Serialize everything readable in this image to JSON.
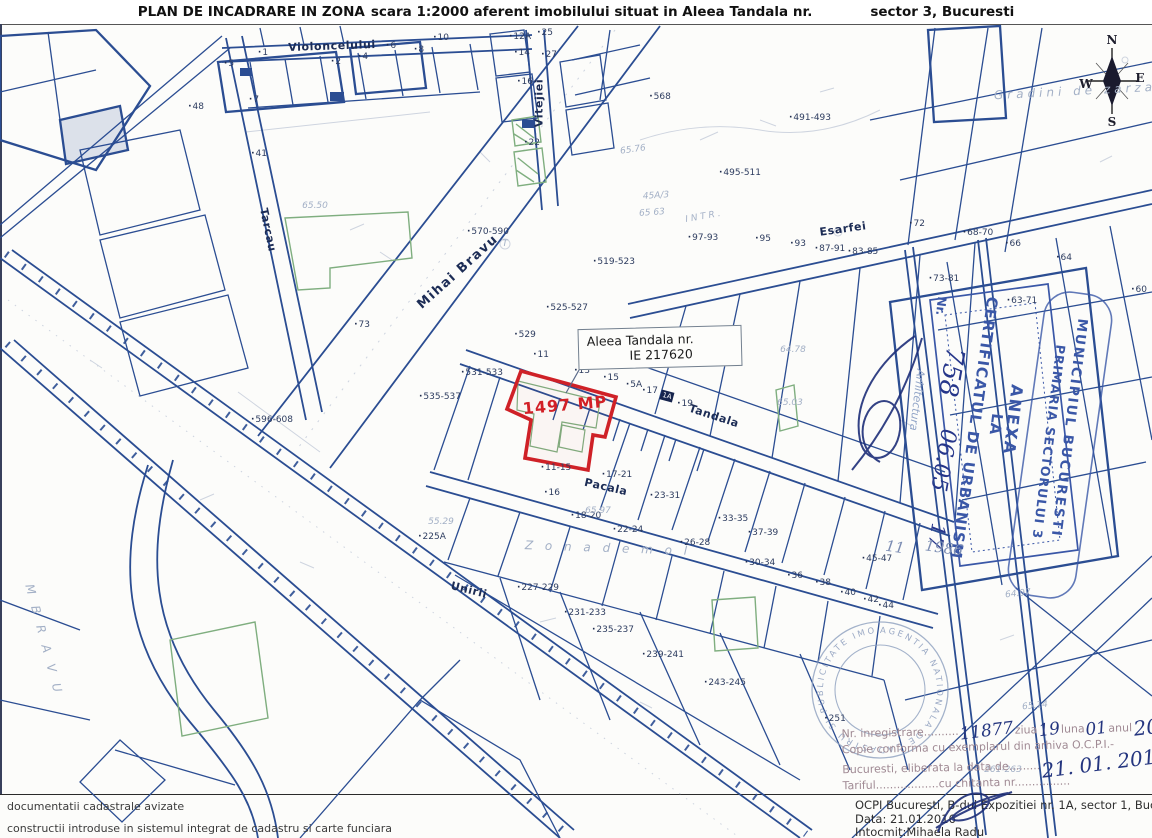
{
  "title": {
    "part1": "PLAN DE INCADRARE IN ZONA",
    "part2": "scara 1:2000 aferent imobilului situat in Aleea Tandala nr.",
    "part3": "sector 3, Bucuresti"
  },
  "parcel_box": {
    "line1": "Aleea Tandala nr.",
    "line2": "IE 217620"
  },
  "area_label": "1497 MP",
  "stamps": {
    "anexa": {
      "word1": "ANEXA",
      "word2": "LA",
      "cert": "CERTIFICATUL DE URBANISM",
      "nr_label": "Nr.",
      "hand_number": "758",
      "hand_date": "06.05",
      "hand_suffix": "17",
      "arch": "Arhitectura"
    },
    "primarie": {
      "line1": "MUNICIPIUL BUCURESTI",
      "line2": "PRIMARIA SECTORULUI 3",
      "hand_a": "11",
      "hand_b": "1986"
    },
    "round": {
      "ring_text": "AGENTIA NATIONALA DE CADASTRU SI PUBLICITATE IMOBILIARA • OFICIUL DE CADASTRU •"
    }
  },
  "registration": {
    "l1_label": "Nr. inregistrare",
    "l1_dots": "..........",
    "h_number": "11877",
    "l1_ziua": "ziua",
    "h_day": "19",
    "l1_luna": "luna",
    "h_month": "01",
    "l1_anul": "anul",
    "h_year": "2016",
    "l2": "Copie conforma cu exemplarul din arhiva O.C.P.I.-",
    "l3": "Bucuresti, eliberata la data de.........",
    "h_date": "21. 01. 2016",
    "l4": "Tariful..................cu chitanta nr................"
  },
  "footer": {
    "legend1": "documentatii cadastrale avizate",
    "legend2": "constructii introduse in sistemul integrat de cadastru si carte funciara",
    "ocpi_line1": "OCPI Bucuresti, B-dul Expozitiei nr. 1A, sector 1, Bucuresti",
    "ocpi_line2": "Data: 21.01.2016",
    "ocpi_line3": "Intocmit:Mihaela Radu"
  },
  "colors": {
    "line_blue": "#2b4d92",
    "red": "#cf2127",
    "green": "#7fae7f",
    "stamp_blue": "#3a57a7",
    "hand_ink": "#24357f"
  },
  "map": {
    "labels": [
      {
        "t": "Violoncelului",
        "x": 332,
        "y": 46,
        "r": -2,
        "c": "st"
      },
      {
        "t": "Vitejiei",
        "x": 539,
        "y": 103,
        "r": -90,
        "c": "st"
      },
      {
        "t": "Tarcau",
        "x": 268,
        "y": 230,
        "r": 78,
        "c": "st"
      },
      {
        "t": "Mihai Bravu",
        "x": 458,
        "y": 272,
        "r": -42,
        "c": "st stbig"
      },
      {
        "t": "Esarfei",
        "x": 843,
        "y": 229,
        "r": -8,
        "c": "st"
      },
      {
        "t": "Tandala",
        "x": 714,
        "y": 416,
        "r": 18,
        "c": "st"
      },
      {
        "t": "Pacala",
        "x": 606,
        "y": 487,
        "r": 13,
        "c": "st"
      },
      {
        "t": "Unirii",
        "x": 469,
        "y": 590,
        "r": 14,
        "c": "st"
      },
      {
        "t": "M B R A V U",
        "x": 44,
        "y": 640,
        "r": 75,
        "c": "faint fbig"
      },
      {
        "t": "I N T R .",
        "x": 703,
        "y": 217,
        "r": -10,
        "c": "faint"
      },
      {
        "t": "Gradini de zarza",
        "x": 1075,
        "y": 91,
        "r": -3,
        "c": "faint fbig"
      },
      {
        "t": "Z o n a     d e m o l",
        "x": 608,
        "y": 548,
        "r": 2,
        "c": "faint fbig"
      },
      {
        "t": "1497 MP",
        "x": 565,
        "y": 405,
        "r": -5,
        "c": "area"
      },
      {
        "t": "1A",
        "x": 667,
        "y": 396,
        "r": 15,
        "c": "bb"
      },
      {
        "t": "N",
        "x": 1112,
        "y": 40,
        "r": 0,
        "c": "cmp"
      },
      {
        "t": "W",
        "x": 1086,
        "y": 84,
        "r": 0,
        "c": "cmp"
      },
      {
        "t": "E",
        "x": 1140,
        "y": 78,
        "r": 0,
        "c": "cmp"
      },
      {
        "t": "S",
        "x": 1112,
        "y": 122,
        "r": 0,
        "c": "cmp"
      },
      {
        "t": "1",
        "x": 263,
        "y": 53,
        "r": 0,
        "c": "hn"
      },
      {
        "t": "5",
        "x": 229,
        "y": 64,
        "r": 0,
        "c": "hn"
      },
      {
        "t": "7",
        "x": 254,
        "y": 100,
        "r": 0,
        "c": "hn"
      },
      {
        "t": "2",
        "x": 336,
        "y": 62,
        "r": 0,
        "c": "hn"
      },
      {
        "t": "4",
        "x": 363,
        "y": 57,
        "r": 0,
        "c": "hn"
      },
      {
        "t": "6",
        "x": 391,
        "y": 46,
        "r": 0,
        "c": "hn"
      },
      {
        "t": "8",
        "x": 419,
        "y": 50,
        "r": 0,
        "c": "hn"
      },
      {
        "t": "10",
        "x": 441,
        "y": 38,
        "r": 0,
        "c": "hn"
      },
      {
        "t": "12A",
        "x": 520,
        "y": 37,
        "r": 0,
        "c": "hn"
      },
      {
        "t": "14",
        "x": 522,
        "y": 53,
        "r": 0,
        "c": "hn"
      },
      {
        "t": "16",
        "x": 525,
        "y": 82,
        "r": 0,
        "c": "hn"
      },
      {
        "t": "25",
        "x": 545,
        "y": 33,
        "r": 0,
        "c": "hn"
      },
      {
        "t": "27",
        "x": 549,
        "y": 55,
        "r": 0,
        "c": "hn"
      },
      {
        "t": "22",
        "x": 532,
        "y": 143,
        "r": 0,
        "c": "hn"
      },
      {
        "t": "41",
        "x": 259,
        "y": 154,
        "r": 0,
        "c": "hn"
      },
      {
        "t": "48",
        "x": 196,
        "y": 107,
        "r": 0,
        "c": "hn"
      },
      {
        "t": "568",
        "x": 660,
        "y": 97,
        "r": 0,
        "c": "hn"
      },
      {
        "t": "570-590",
        "x": 488,
        "y": 232,
        "r": 0,
        "c": "hn"
      },
      {
        "t": "519-523",
        "x": 614,
        "y": 262,
        "r": 0,
        "c": "hn"
      },
      {
        "t": "525-527",
        "x": 567,
        "y": 308,
        "r": 0,
        "c": "hn"
      },
      {
        "t": "529",
        "x": 525,
        "y": 335,
        "r": 0,
        "c": "hn"
      },
      {
        "t": "11",
        "x": 541,
        "y": 355,
        "r": 0,
        "c": "hn"
      },
      {
        "t": "531-533",
        "x": 482,
        "y": 373,
        "r": 0,
        "c": "hn"
      },
      {
        "t": "535-537",
        "x": 440,
        "y": 397,
        "r": 0,
        "c": "hn"
      },
      {
        "t": "596-608",
        "x": 272,
        "y": 420,
        "r": 0,
        "c": "hn"
      },
      {
        "t": "73",
        "x": 362,
        "y": 325,
        "r": 0,
        "c": "hn"
      },
      {
        "t": "13",
        "x": 582,
        "y": 371,
        "r": 0,
        "c": "hn"
      },
      {
        "t": "15",
        "x": 611,
        "y": 378,
        "r": 0,
        "c": "hn"
      },
      {
        "t": "5A",
        "x": 634,
        "y": 385,
        "r": 0,
        "c": "hn"
      },
      {
        "t": "17",
        "x": 650,
        "y": 391,
        "r": 0,
        "c": "hn"
      },
      {
        "t": "19",
        "x": 685,
        "y": 404,
        "r": 0,
        "c": "hn"
      },
      {
        "t": "11-15",
        "x": 556,
        "y": 468,
        "r": 0,
        "c": "hn"
      },
      {
        "t": "17-21",
        "x": 617,
        "y": 475,
        "r": 0,
        "c": "hn"
      },
      {
        "t": "23-31",
        "x": 665,
        "y": 496,
        "r": 0,
        "c": "hn"
      },
      {
        "t": "16",
        "x": 552,
        "y": 493,
        "r": 0,
        "c": "hn"
      },
      {
        "t": "18-20",
        "x": 586,
        "y": 516,
        "r": 0,
        "c": "hn"
      },
      {
        "t": "22-24",
        "x": 628,
        "y": 530,
        "r": 0,
        "c": "hn"
      },
      {
        "t": "33-35",
        "x": 733,
        "y": 519,
        "r": 0,
        "c": "hn"
      },
      {
        "t": "26-28",
        "x": 695,
        "y": 543,
        "r": 0,
        "c": "hn"
      },
      {
        "t": "37-39",
        "x": 763,
        "y": 533,
        "r": 0,
        "c": "hn"
      },
      {
        "t": "30-34",
        "x": 760,
        "y": 563,
        "r": 0,
        "c": "hn"
      },
      {
        "t": "36",
        "x": 795,
        "y": 576,
        "r": 0,
        "c": "hn"
      },
      {
        "t": "225A",
        "x": 432,
        "y": 537,
        "r": 0,
        "c": "hn"
      },
      {
        "t": "227-229",
        "x": 538,
        "y": 588,
        "r": 0,
        "c": "hn"
      },
      {
        "t": "231-233",
        "x": 585,
        "y": 613,
        "r": 0,
        "c": "hn"
      },
      {
        "t": "235-237",
        "x": 613,
        "y": 630,
        "r": 0,
        "c": "hn"
      },
      {
        "t": "239-241",
        "x": 663,
        "y": 655,
        "r": 0,
        "c": "hn"
      },
      {
        "t": "243-245",
        "x": 725,
        "y": 683,
        "r": 0,
        "c": "hn"
      },
      {
        "t": "97-93",
        "x": 703,
        "y": 238,
        "r": 0,
        "c": "hn"
      },
      {
        "t": "95",
        "x": 763,
        "y": 239,
        "r": 0,
        "c": "hn"
      },
      {
        "t": "93",
        "x": 798,
        "y": 244,
        "r": 0,
        "c": "hn"
      },
      {
        "t": "87-91",
        "x": 830,
        "y": 249,
        "r": 0,
        "c": "hn"
      },
      {
        "t": "83-85",
        "x": 863,
        "y": 252,
        "r": 0,
        "c": "hn"
      },
      {
        "t": "72",
        "x": 917,
        "y": 224,
        "r": 0,
        "c": "hn"
      },
      {
        "t": "491-493",
        "x": 810,
        "y": 118,
        "r": 0,
        "c": "hn"
      },
      {
        "t": "495-511",
        "x": 740,
        "y": 173,
        "r": 0,
        "c": "hn"
      },
      {
        "t": "68-70",
        "x": 978,
        "y": 233,
        "r": 0,
        "c": "hn"
      },
      {
        "t": "66",
        "x": 1013,
        "y": 244,
        "r": 0,
        "c": "hn"
      },
      {
        "t": "64",
        "x": 1064,
        "y": 258,
        "r": 0,
        "c": "hn"
      },
      {
        "t": "60",
        "x": 1139,
        "y": 290,
        "r": 0,
        "c": "hn"
      },
      {
        "t": "73-81",
        "x": 944,
        "y": 279,
        "r": 0,
        "c": "hn"
      },
      {
        "t": "63-71",
        "x": 1022,
        "y": 301,
        "r": 0,
        "c": "hn"
      },
      {
        "t": "45-47",
        "x": 877,
        "y": 559,
        "r": 0,
        "c": "hn"
      },
      {
        "t": "38",
        "x": 823,
        "y": 583,
        "r": 0,
        "c": "hn"
      },
      {
        "t": "40",
        "x": 848,
        "y": 593,
        "r": 0,
        "c": "hn"
      },
      {
        "t": "42",
        "x": 871,
        "y": 600,
        "r": 0,
        "c": "hn"
      },
      {
        "t": "44",
        "x": 886,
        "y": 606,
        "r": 0,
        "c": "hn"
      },
      {
        "t": "251",
        "x": 835,
        "y": 719,
        "r": 0,
        "c": "hn"
      },
      {
        "t": "261-263",
        "x": 1003,
        "y": 770,
        "r": 0,
        "c": "faint"
      },
      {
        "t": "45A/3",
        "x": 656,
        "y": 196,
        "r": -4,
        "c": "faint"
      },
      {
        "t": "65 63",
        "x": 652,
        "y": 213,
        "r": -4,
        "c": "faint"
      },
      {
        "t": "65.50",
        "x": 315,
        "y": 206,
        "r": 0,
        "c": "faint"
      },
      {
        "t": "65.76",
        "x": 633,
        "y": 150,
        "r": -8,
        "c": "faint"
      },
      {
        "t": "64.78",
        "x": 793,
        "y": 350,
        "r": 0,
        "c": "faint"
      },
      {
        "t": "65.03",
        "x": 790,
        "y": 403,
        "r": 0,
        "c": "faint"
      },
      {
        "t": "65.97",
        "x": 598,
        "y": 511,
        "r": 0,
        "c": "faint"
      },
      {
        "t": "64.97",
        "x": 1018,
        "y": 594,
        "r": -6,
        "c": "faint"
      },
      {
        "t": "65.14",
        "x": 1035,
        "y": 706,
        "r": -6,
        "c": "faint"
      },
      {
        "t": "55.29",
        "x": 441,
        "y": 522,
        "r": 0,
        "c": "faint"
      },
      {
        "t": "T",
        "x": 505,
        "y": 244,
        "r": 0,
        "c": "faint"
      }
    ]
  }
}
